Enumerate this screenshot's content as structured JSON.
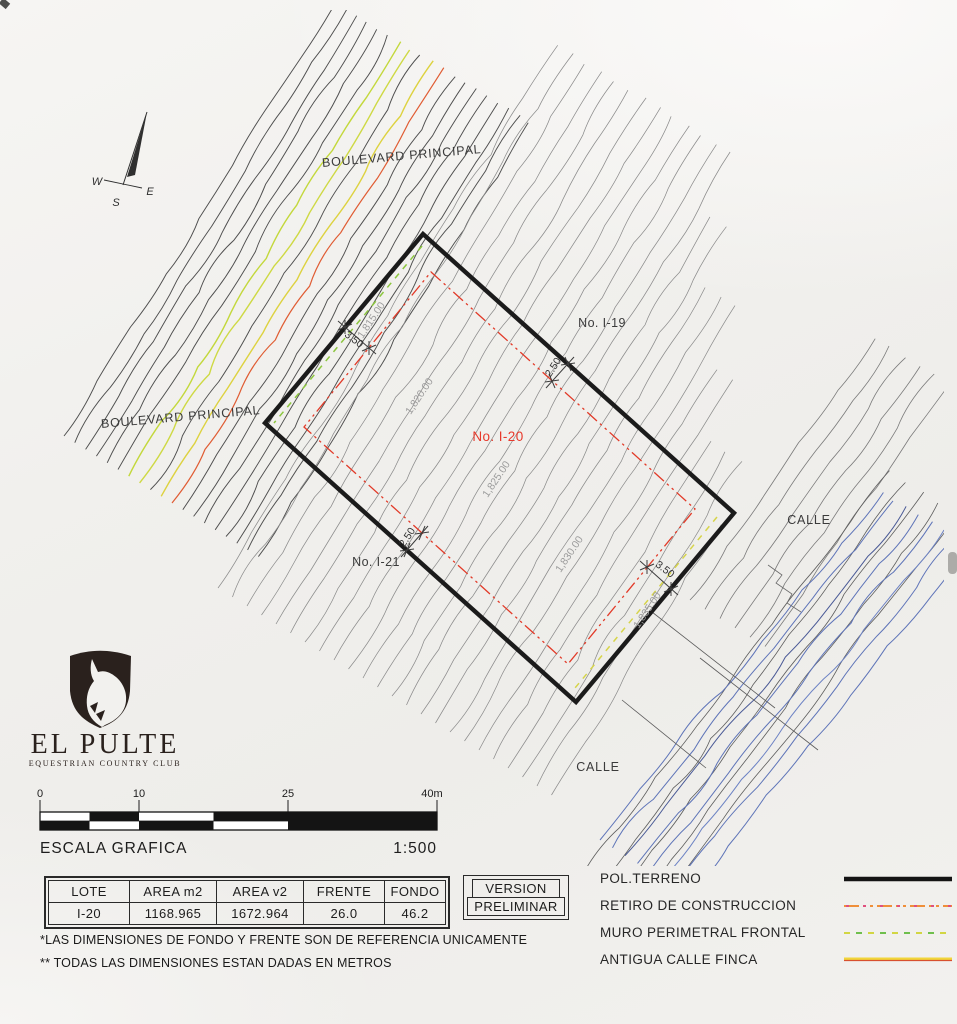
{
  "map": {
    "boulevard_top": "BOULEVARD PRINCIPAL",
    "boulevard_left": "BOULEVARD PRINCIPAL",
    "lot_no_19": "No. I-19",
    "lot_no_20": "No. I-20",
    "lot_no_21": "No. I-21",
    "calle_right": "CALLE",
    "calle_bottom": "CALLE",
    "contour_labels": [
      "1,815.00",
      "1,820.00",
      "1,825.00",
      "1,830.00",
      "1,835.00"
    ],
    "dim_front": "3.50",
    "dim_side_top": "2.50",
    "dim_side_bottom": "2.50",
    "dim_back": "3.50",
    "compass": {
      "west": "W",
      "east": "E",
      "south": "S"
    }
  },
  "logo": {
    "title": "EL PULTE",
    "subtitle": "EQUESTRIAN COUNTRY CLUB"
  },
  "scale_bar": {
    "ticks": [
      "0",
      "10",
      "25",
      "40m"
    ],
    "label": "ESCALA GRAFICA",
    "ratio": "1:500"
  },
  "lot_table": {
    "headers": [
      "LOTE",
      "AREA m2",
      "AREA v2",
      "FRENTE",
      "FONDO"
    ],
    "row": [
      "I-20",
      "1168.965",
      "1672.964",
      "26.0",
      "46.2"
    ]
  },
  "version_box": {
    "title": "VERSION",
    "value": "PRELIMINAR"
  },
  "legend": [
    {
      "label": "POL.TERRENO",
      "style": "solid-black"
    },
    {
      "label": "RETIRO DE CONSTRUCCION",
      "style": "orange-red-dash-dot"
    },
    {
      "label": "MURO PERIMETRAL FRONTAL",
      "style": "green-yellow-dashed"
    },
    {
      "label": "ANTIGUA CALLE FINCA",
      "style": "yellow-red-solid"
    }
  ],
  "notes": [
    "*LAS DIMENSIONES DE FONDO Y FRENTE SON DE REFERENCIA UNICAMENTE",
    "** TODAS LAS DIMENSIONES ESTAN DADAS EN METROS"
  ],
  "colors": {
    "lot_outline": "#1b1b1b",
    "retiro_red": "#e23a28",
    "muro_green": "#8cc63f",
    "antigua_yellow": "#eed33c",
    "antigua_red": "#d8502f",
    "contour_dark": "#4e4e4e",
    "contour_light": "#8c8c8c",
    "calle_blue": "#5e74b8"
  }
}
